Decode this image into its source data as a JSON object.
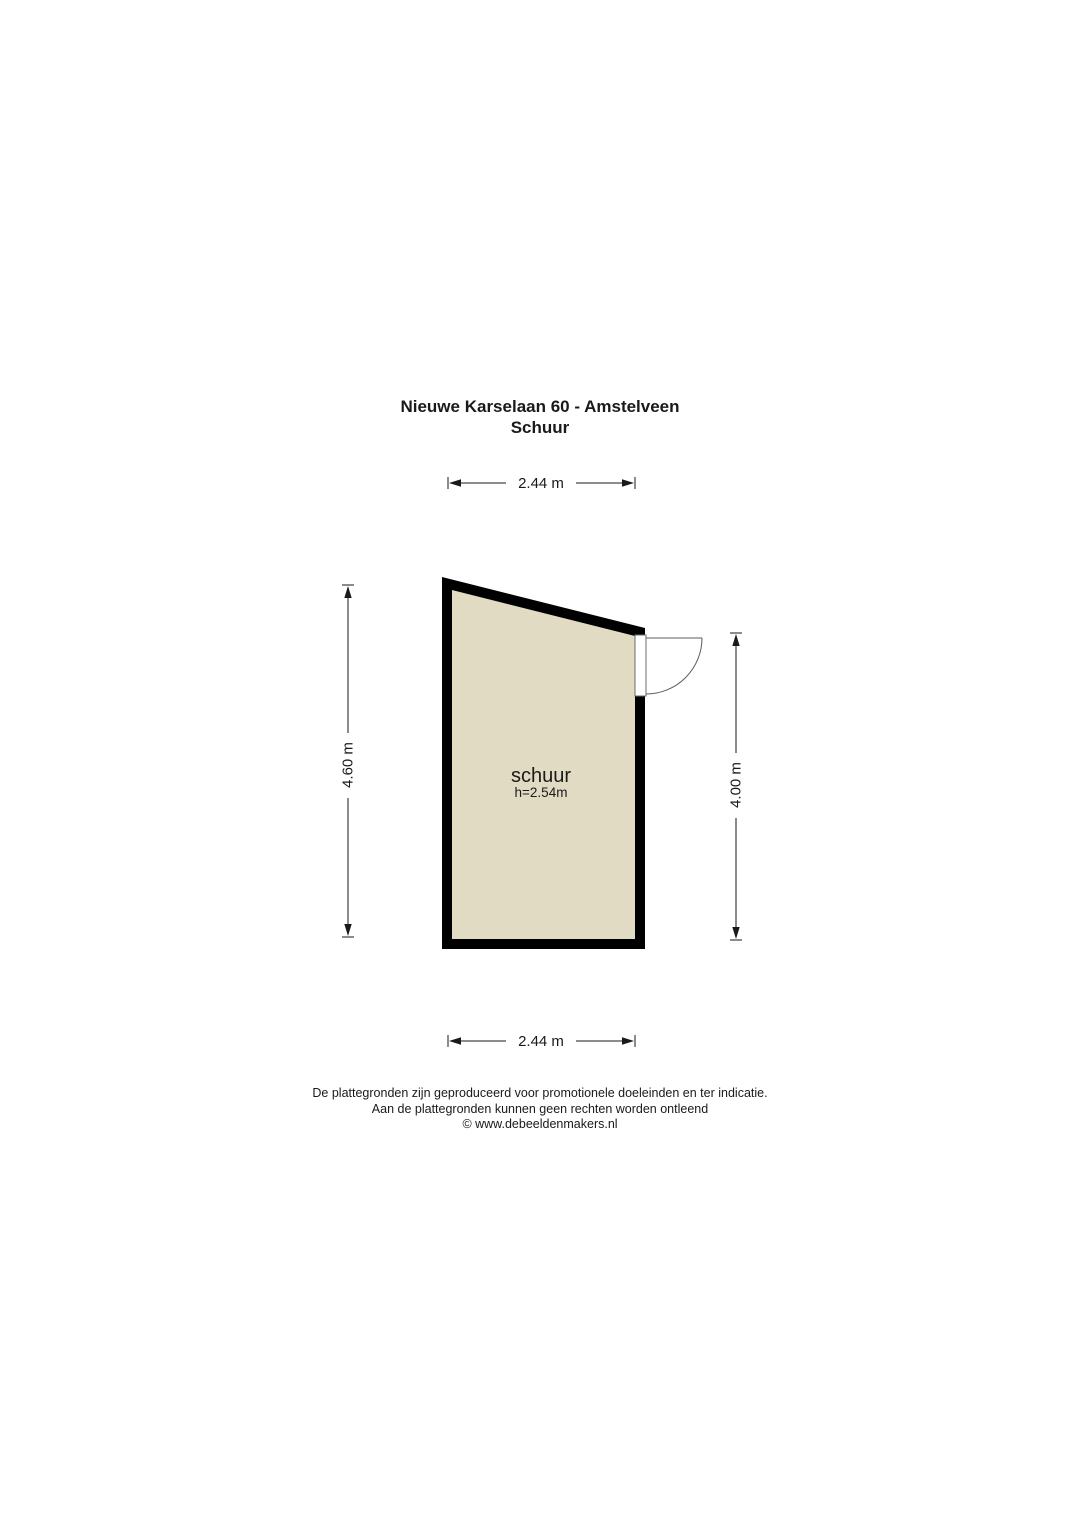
{
  "title": {
    "line1": "Nieuwe Karselaan 60 - Amstelveen",
    "line2": "Schuur"
  },
  "room": {
    "label": "schuur",
    "ceiling_height": "h=2.54m"
  },
  "dimensions": {
    "top": "2.44 m",
    "bottom": "2.44 m",
    "left": "4.60 m",
    "right": "4.00 m"
  },
  "footer": {
    "line1": "De plattegronden zijn geproduceerd voor promotionele doeleinden en ter indicatie.",
    "line2": "Aan de plattegronden kunnen geen rechten worden ontleend",
    "line3": "© www.debeeldenmakers.nl"
  },
  "colors": {
    "background": "#ffffff",
    "wall": "#000000",
    "room_fill": "#e2dbc4",
    "line": "#1a1a1a"
  }
}
